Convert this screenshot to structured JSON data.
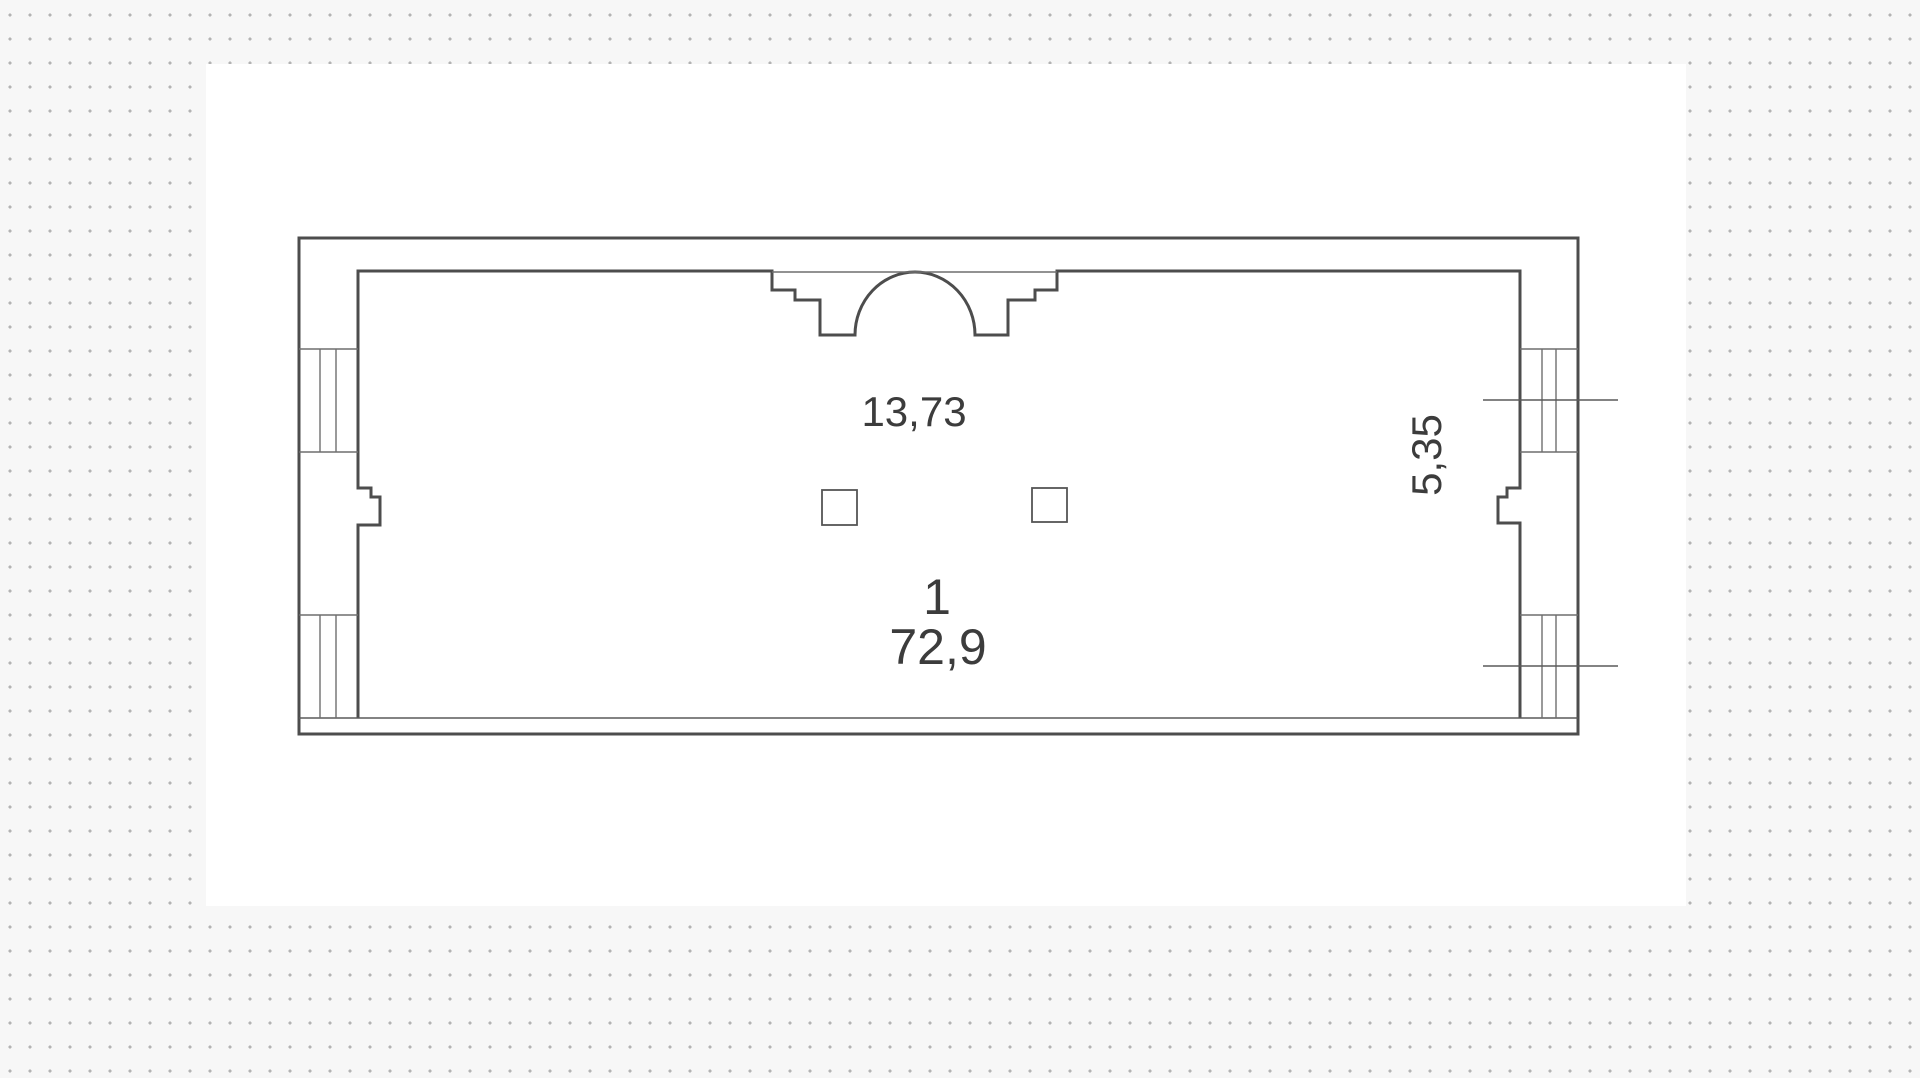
{
  "floor_plan": {
    "room": {
      "number": "1",
      "area": "72,9"
    },
    "dimensions": {
      "width_label": "13,73",
      "depth_label": "5,35"
    },
    "colors": {
      "wall_line": "#4d4d4d",
      "thin_line": "#6e6e6e",
      "dot_grid": "#b3b3b3",
      "canvas_bg": "#ffffff",
      "margin_bg": "#f7f7f7",
      "text": "#3c3c3c"
    }
  }
}
